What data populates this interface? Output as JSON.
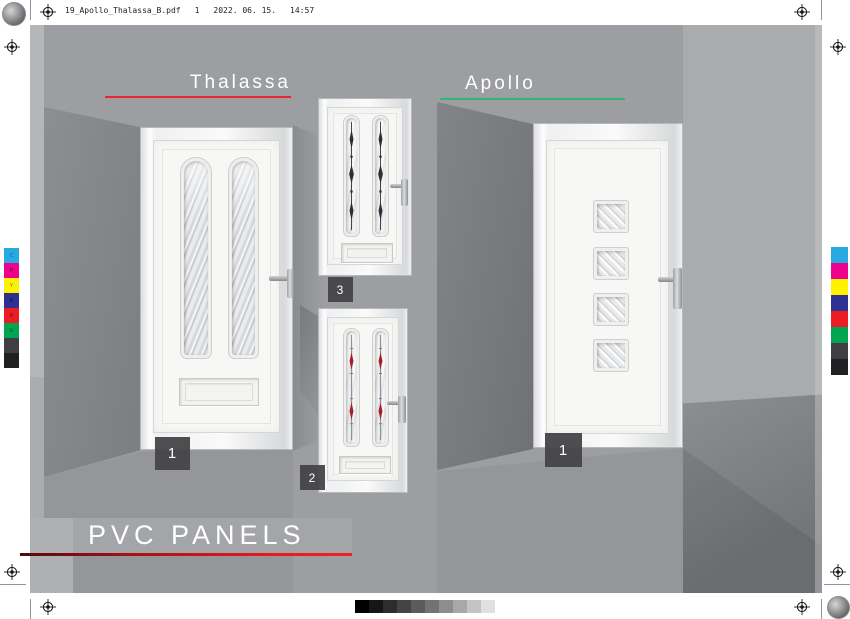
{
  "header": {
    "filename": "19_Apollo_Thalassa_B.pdf",
    "page_number": "1",
    "date": "2022. 06. 15.",
    "time": "14:57"
  },
  "sections": {
    "thalassa": {
      "title": "Thalassa",
      "underline_color": "#e8262d",
      "door_large_label": "1",
      "door_top_label": "3",
      "door_bottom_label": "2"
    },
    "apollo": {
      "title": "Apollo",
      "underline_color": "#2eb871",
      "door_label": "1"
    }
  },
  "footer": {
    "title": "PVC PANELS",
    "underline_color": "#e01b23"
  },
  "print_marks": {
    "color_bar": [
      {
        "name": "cyan",
        "color": "#27aae1",
        "letter": "C"
      },
      {
        "name": "magenta",
        "color": "#ec008c",
        "letter": "M"
      },
      {
        "name": "yellow",
        "color": "#fff200",
        "letter": "Y"
      },
      {
        "name": "blue",
        "color": "#2e3192",
        "letter": "B"
      },
      {
        "name": "red",
        "color": "#ec1c24",
        "letter": "R"
      },
      {
        "name": "green",
        "color": "#00a551",
        "letter": "G"
      },
      {
        "name": "gray-80",
        "color": "#3f3f41",
        "letter": ""
      },
      {
        "name": "black",
        "color": "#202022",
        "letter": ""
      }
    ],
    "grayscale_steps": [
      "#000000",
      "#161616",
      "#2d2d2d",
      "#444444",
      "#5b5b5b",
      "#737373",
      "#8d8d8d",
      "#a8a8a8",
      "#c4c4c4",
      "#e0e0e0"
    ]
  }
}
